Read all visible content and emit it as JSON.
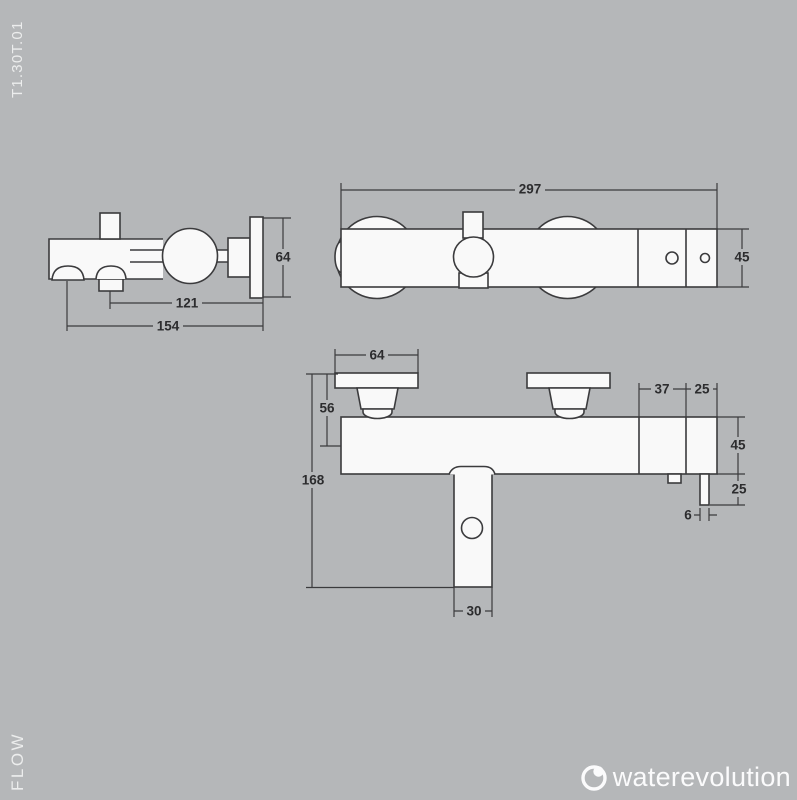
{
  "meta": {
    "product_code": "T1.30T.01",
    "series_label": "FLOW"
  },
  "brand": {
    "name": "waterevolution",
    "icon": "water-drop-ring-icon"
  },
  "colors": {
    "background": "#b5b7b9",
    "line": "#3b3b3d",
    "shape_fill": "#f9f9f9",
    "dim_text": "#2c2c2e",
    "side_text": "#eceded"
  },
  "views": {
    "side": {
      "dims": {
        "plate_height": "64",
        "spout_to_wall": "121",
        "total_depth": "154"
      }
    },
    "top": {
      "dims": {
        "total_width": "297",
        "body_depth": "45"
      }
    },
    "front": {
      "dims": {
        "escutcheon_width": "64",
        "wall_to_axis": "56",
        "total_height": "168",
        "spout_width": "30",
        "end_section": "37",
        "cap_section": "25",
        "body_height": "45",
        "lever_drop": "25",
        "lever_width": "6"
      }
    }
  }
}
